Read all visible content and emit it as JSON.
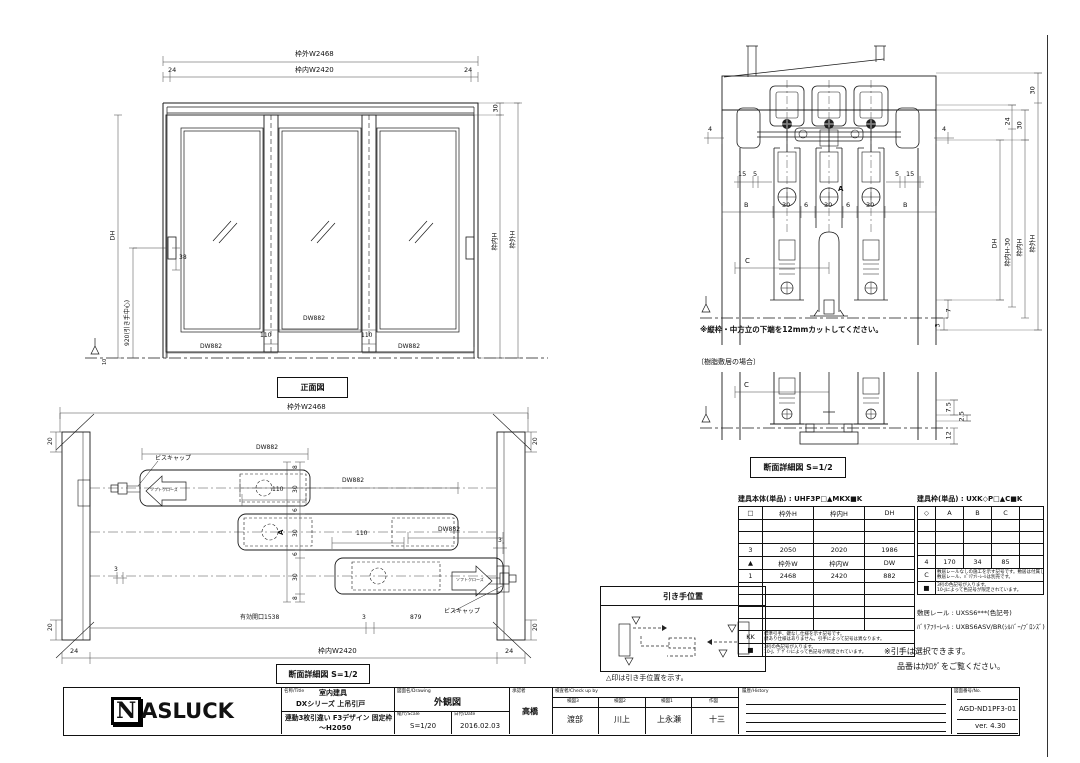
{
  "front": {
    "caption": "正面図",
    "dim_w_outer": "枠外W2468",
    "dim_w_inner": "枠内W2420",
    "dim24l": "24",
    "dim24r": "24",
    "dim30": "30",
    "dim_h_inner": "枠内H",
    "dim_h_outer": "枠外H",
    "dim_dh": "DH",
    "dim_handle": "920(引き手中心)",
    "dim38": "38",
    "dim10": "10",
    "dw": [
      "DW882",
      "DW882",
      "DW882"
    ],
    "lap": [
      "110",
      "110"
    ]
  },
  "section": {
    "note": "※縦枠・中方立の下端を12mmカットしてください。",
    "dim4l": "4",
    "dim4r": "4",
    "d15l": "15",
    "d5l": "5",
    "d5r": "5",
    "d15r": "15",
    "row": [
      "B",
      "30",
      "6",
      "30",
      "6",
      "30",
      "B"
    ],
    "labelA": "A",
    "labelC": "C",
    "right": {
      "d30top": "30",
      "d24": "24",
      "d30": "30",
      "dh": "DH",
      "inner30": "枠内H-30",
      "inner": "枠内H",
      "outer": "枠外H",
      "d7": "7",
      "d3": "3"
    }
  },
  "resin": {
    "bracket": "〔樹脂敷居の場合〕",
    "labelC": "C",
    "d75": "7.5",
    "d25": "2.5",
    "d12": "12",
    "caption": "断面詳細図 S=1/2"
  },
  "plan": {
    "dim_w_outer": "枠外W2468",
    "dim_w_inner": "枠内W2420",
    "dim24l": "24",
    "dim24r": "24",
    "dw1": "DW882",
    "dw2": "DW882",
    "dw3": "DW882",
    "lap1": "110",
    "lap2": "110",
    "opening": "有効開口1538",
    "d3a": "3",
    "d879": "879",
    "d3l": "3",
    "d3r": "3",
    "chain": [
      "8",
      "30",
      "6",
      "30",
      "6",
      "30",
      "8"
    ],
    "labelA": "A",
    "d20": [
      "20",
      "20",
      "20",
      "20"
    ],
    "screwcap1": "ビスキャップ",
    "screwcap2": "ビスキャップ",
    "softclose1": "ソフトクローズ",
    "softclose2": "ソフトクローズ",
    "caption": "断面詳細図 S=1/2"
  },
  "handle_box": {
    "title": "引き手位置",
    "note": "△印は引き手位置を示す。"
  },
  "body_table": {
    "title": "建具本体(単品) : UHF3P□▲MKX■K",
    "headers": [
      "□",
      "枠外H",
      "枠内H",
      "DH"
    ],
    "row3": [
      "3",
      "2050",
      "2020",
      "1986"
    ],
    "rowT": [
      "▲",
      "枠外W",
      "枠内W",
      "DW"
    ],
    "row1": [
      "1",
      "2468",
      "2420",
      "882"
    ],
    "kk": "KK",
    "kk_note1": "標準引手、鍵なし仕様を示す記号です。",
    "kk_note2": "鍵あり仕様はありません。引手によって記号は異なります。",
    "sq": "■",
    "sq_note1": "3桁の色記号が入ります。",
    "sq_note2": "10-J、ﾃﾞｻﾞｲﾝによって色記号が限定されています。"
  },
  "frame_table": {
    "title": "建具枠(単品) : UXK◇P□▲C■K",
    "headers": [
      "◇",
      "A",
      "B",
      "C",
      ""
    ],
    "row4": [
      "4",
      "170",
      "34",
      "85",
      ""
    ],
    "c": "C",
    "c_note1": "敷居レールなしの施工を示す記号です。敷居は付属しません。",
    "c_note2": "敷居レール、ﾊﾞﾘｱﾌﾘｰﾚｰﾙは別売です。",
    "sq": "■",
    "sq_note1": "3桁の色記号が入ります。",
    "sq_note2": "10-Jによって色記号が限定されています。",
    "rail": "敷居レール : UXSS6***(色記号)",
    "bf_rail": "ﾊﾞﾘｱﾌﾘｰﾚｰﾙ : UXBS6ASV/BR(ｼﾙﾊﾞｰ/ﾌﾞﾛﾝｽﾞ)",
    "note1": "※引手は選択できます。",
    "note2": "品番はｶﾀﾛｸﾞをご覧ください。"
  },
  "title_block": {
    "logo_n": "N",
    "logo": "ASLUCK",
    "name_header": "名称/Title",
    "name1": "室内建具",
    "name2": "DXシリーズ 上吊引戸",
    "name3": "連動3枚引違い F3デザイン 固定枠",
    "name4": "～H2050",
    "drawing_header": "図面名/Drawing",
    "drawing": "外観図",
    "scale_header": "縮尺/Scale",
    "scale": "S=1/20",
    "date_header": "日付/Date",
    "date": "2016.02.03",
    "approve_header": "承認者",
    "approver": "高橋",
    "check_header": "検査者/Check up by",
    "check_cols": [
      {
        "h": "検図3",
        "v": "渡部"
      },
      {
        "h": "検図2",
        "v": "川上"
      },
      {
        "h": "検図1",
        "v": "上永瀬"
      },
      {
        "h": "作図",
        "v": "十三"
      }
    ],
    "history_header": "履歴/History",
    "no_header": "図面番号/No.",
    "number": "AGD-ND1PF3-01",
    "version": "ver. 4.30"
  }
}
